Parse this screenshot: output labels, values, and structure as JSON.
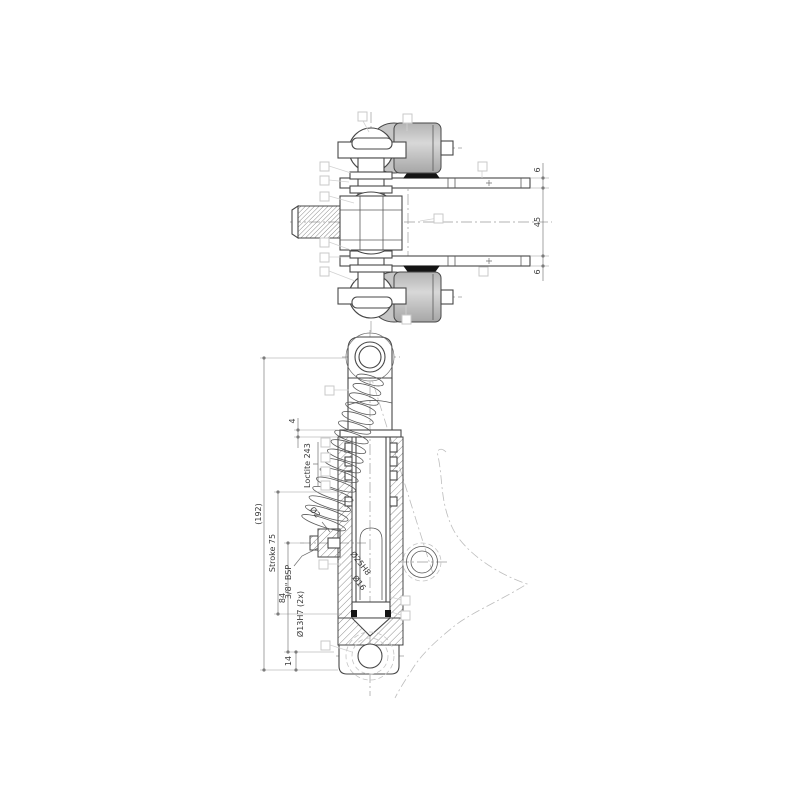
{
  "drawing": {
    "kind": "hydraulic-cylinder-assembly-drawing",
    "views": [
      "plan-view",
      "sectioned-side-view"
    ],
    "colors": {
      "line": "#474747",
      "roller_fill": "#c9c9c9",
      "rubber_pad_fill": "#141414",
      "balloon_stroke": "#c9c9c9",
      "background": "#ffffff"
    },
    "labels": {
      "top_view": {
        "arm_thickness_top": "6",
        "arms_gap": "45",
        "arm_thickness_bottom": "6"
      },
      "section_view": {
        "overall_length": "(192)",
        "stroke": "Stroke 75",
        "port_thread": "3/8\" BSP",
        "port_to_pin": "84",
        "pin_hole": "Ø13H7 (2x)",
        "pin_to_base": "14",
        "gland_height": "4",
        "orifice": "Ø2",
        "bore_dia": "Ø25H8",
        "rod_dia": "Ø16",
        "adhesive_note": "Loctite 243"
      }
    }
  }
}
